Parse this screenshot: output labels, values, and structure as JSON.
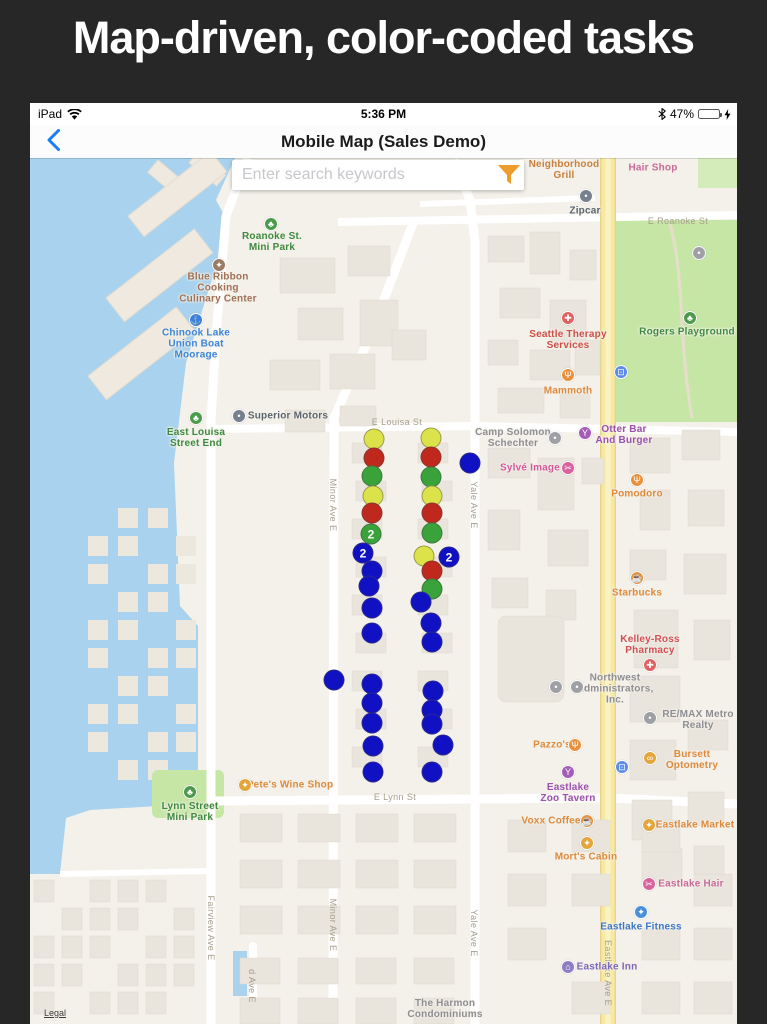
{
  "banner": {
    "title": "Map-driven, color-coded tasks"
  },
  "status_bar": {
    "carrier": "iPad",
    "time": "5:36 PM",
    "battery_percent": "47%"
  },
  "nav_bar": {
    "title": "Mobile Map (Sales Demo)"
  },
  "search": {
    "placeholder": "Enter search keywords"
  },
  "colors": {
    "accent_orange": "#EE9D2B",
    "battery_green": "#53D769",
    "nav_blue": "#157EFB",
    "marker": {
      "y": "#DCE24A",
      "r": "#BF291D",
      "g": "#3AA23A",
      "b": "#1111C4"
    }
  },
  "map": {
    "attribution": "Legal",
    "markers": [
      {
        "x": 344,
        "y": 281,
        "c": "y"
      },
      {
        "x": 344,
        "y": 300,
        "c": "r"
      },
      {
        "x": 342,
        "y": 318,
        "c": "g"
      },
      {
        "x": 343,
        "y": 338,
        "c": "y"
      },
      {
        "x": 342,
        "y": 355,
        "c": "r"
      },
      {
        "x": 341,
        "y": 376,
        "c": "g",
        "n": "2"
      },
      {
        "x": 333,
        "y": 395,
        "c": "b",
        "n": "2"
      },
      {
        "x": 342,
        "y": 413,
        "c": "b"
      },
      {
        "x": 339,
        "y": 428,
        "c": "b"
      },
      {
        "x": 342,
        "y": 450,
        "c": "b"
      },
      {
        "x": 342,
        "y": 475,
        "c": "b"
      },
      {
        "x": 342,
        "y": 526,
        "c": "b"
      },
      {
        "x": 342,
        "y": 545,
        "c": "b"
      },
      {
        "x": 342,
        "y": 565,
        "c": "b"
      },
      {
        "x": 343,
        "y": 588,
        "c": "b"
      },
      {
        "x": 343,
        "y": 614,
        "c": "b"
      },
      {
        "x": 401,
        "y": 280,
        "c": "y"
      },
      {
        "x": 401,
        "y": 299,
        "c": "r"
      },
      {
        "x": 401,
        "y": 319,
        "c": "g"
      },
      {
        "x": 402,
        "y": 338,
        "c": "y"
      },
      {
        "x": 402,
        "y": 355,
        "c": "r"
      },
      {
        "x": 402,
        "y": 375,
        "c": "g"
      },
      {
        "x": 394,
        "y": 398,
        "c": "y"
      },
      {
        "x": 419,
        "y": 399,
        "c": "b",
        "n": "2"
      },
      {
        "x": 402,
        "y": 413,
        "c": "r"
      },
      {
        "x": 402,
        "y": 431,
        "c": "g"
      },
      {
        "x": 391,
        "y": 444,
        "c": "b"
      },
      {
        "x": 401,
        "y": 465,
        "c": "b"
      },
      {
        "x": 402,
        "y": 484,
        "c": "b"
      },
      {
        "x": 403,
        "y": 533,
        "c": "b"
      },
      {
        "x": 402,
        "y": 552,
        "c": "b"
      },
      {
        "x": 402,
        "y": 566,
        "c": "b"
      },
      {
        "x": 413,
        "y": 587,
        "c": "b"
      },
      {
        "x": 402,
        "y": 614,
        "c": "b"
      },
      {
        "x": 440,
        "y": 305,
        "c": "b"
      },
      {
        "x": 304,
        "y": 522,
        "c": "b"
      }
    ],
    "pois": [
      {
        "name": "Neighborhood Grill",
        "lines": [
          "Neighborhood",
          "Grill"
        ],
        "tx": 534,
        "ty": 12,
        "color": "#C8803C"
      },
      {
        "name": "Hair Shop",
        "lines": [
          "Hair Shop"
        ],
        "tx": 623,
        "ty": 10,
        "color": "#C9699A"
      },
      {
        "name": "Zipcar",
        "lines": [
          "Zipcar"
        ],
        "tx": 555,
        "ty": 53,
        "color": "#5B6570",
        "icon": {
          "g": "•",
          "bg": "#76808E",
          "x": 556,
          "y": 38
        }
      },
      {
        "name": "Rogers Playground",
        "lines": [
          "Rogers Playground"
        ],
        "tx": 657,
        "ty": 174,
        "color": "#3E8A3E",
        "icon": {
          "g": "♣",
          "bg": "#4C9B4C",
          "x": 660,
          "y": 160
        }
      },
      {
        "name": "Seattle Therapy Services",
        "lines": [
          "Seattle Therapy",
          "Services"
        ],
        "tx": 538,
        "ty": 182,
        "color": "#CE4F46",
        "icon": {
          "g": "✚",
          "bg": "#E16060",
          "x": 538,
          "y": 160
        }
      },
      {
        "name": "Mammoth",
        "lines": [
          "Mammoth"
        ],
        "tx": 538,
        "ty": 233,
        "color": "#DD8A3C",
        "icon": {
          "g": "Ψ",
          "bg": "#E8913C",
          "x": 538,
          "y": 217
        }
      },
      {
        "name": "Camp Solomon Schechter",
        "lines": [
          "Camp Solomon",
          "Schechter"
        ],
        "tx": 483,
        "ty": 280,
        "color": "#8E8E93",
        "icon": {
          "g": "•",
          "bg": "#9FA0A5",
          "x": 525,
          "y": 280
        }
      },
      {
        "name": "Otter Bar And Burger",
        "lines": [
          "Otter Bar",
          "And Burger"
        ],
        "tx": 594,
        "ty": 277,
        "color": "#9C50B0",
        "icon": {
          "g": "Y",
          "bg": "#A55CB8",
          "x": 555,
          "y": 275
        }
      },
      {
        "name": "Sylvé Image",
        "lines": [
          "Sylvé Image"
        ],
        "tx": 500,
        "ty": 310,
        "color": "#D4579F",
        "icon": {
          "g": "✂",
          "bg": "#D8619E",
          "x": 538,
          "y": 310
        }
      },
      {
        "name": "Pomodoro",
        "lines": [
          "Pomodoro"
        ],
        "tx": 607,
        "ty": 336,
        "color": "#DD8A3C",
        "icon": {
          "g": "Ψ",
          "bg": "#E8913C",
          "x": 607,
          "y": 322
        }
      },
      {
        "name": "Starbucks",
        "lines": [
          "Starbucks"
        ],
        "tx": 607,
        "ty": 435,
        "color": "#DD8A3C",
        "icon": {
          "g": "☕",
          "bg": "#E8913C",
          "x": 607,
          "y": 420
        }
      },
      {
        "name": "Kelley-Ross Pharmacy",
        "lines": [
          "Kelley-Ross",
          "Pharmacy"
        ],
        "tx": 620,
        "ty": 487,
        "color": "#D14F55",
        "icon": {
          "g": "✚",
          "bg": "#E16060",
          "x": 620,
          "y": 507
        }
      },
      {
        "name": "Northwest Administrators, Inc.",
        "lines": [
          "Northwest",
          "Administrators,",
          "Inc."
        ],
        "tx": 585,
        "ty": 531,
        "color": "#8E8E93"
      },
      {
        "name": "office-dot-1",
        "lines": [],
        "tx": 0,
        "ty": 0,
        "color": "#8E8E93",
        "icon": {
          "g": "•",
          "bg": "#9FA0A5",
          "x": 526,
          "y": 529
        }
      },
      {
        "name": "office-dot-2",
        "lines": [],
        "tx": 0,
        "ty": 0,
        "color": "#8E8E93",
        "icon": {
          "g": "•",
          "bg": "#9FA0A5",
          "x": 547,
          "y": 529
        }
      },
      {
        "name": "RE/MAX Metro Realty",
        "lines": [
          "RE/MAX Metro",
          "Realty"
        ],
        "tx": 668,
        "ty": 562,
        "color": "#8E8E93",
        "icon": {
          "g": "•",
          "bg": "#9FA0A5",
          "x": 620,
          "y": 560
        }
      },
      {
        "name": "Pazzo's",
        "lines": [
          "Pazzo's"
        ],
        "tx": 522,
        "ty": 587,
        "color": "#DD8A3C",
        "icon": {
          "g": "Ψ",
          "bg": "#E8913C",
          "x": 545,
          "y": 587
        }
      },
      {
        "name": "Bursett Optometry",
        "lines": [
          "Bursett",
          "Optometry"
        ],
        "tx": 662,
        "ty": 602,
        "color": "#DD8A3C",
        "icon": {
          "g": "∞",
          "bg": "#E2A63D",
          "x": 620,
          "y": 600
        }
      },
      {
        "name": "Eastlake Zoo Tavern",
        "lines": [
          "Eastlake",
          "Zoo Tavern"
        ],
        "tx": 538,
        "ty": 635,
        "color": "#9C50B0",
        "icon": {
          "g": "Y",
          "bg": "#A55CB8",
          "x": 538,
          "y": 614
        }
      },
      {
        "name": "Pete's Wine Shop",
        "lines": [
          "Pete's Wine Shop"
        ],
        "tx": 260,
        "ty": 627,
        "color": "#DD8A3C",
        "icon": {
          "g": "✦",
          "bg": "#E2A63D",
          "x": 215,
          "y": 627
        }
      },
      {
        "name": "Lynn Street Mini Park",
        "lines": [
          "Lynn Street",
          "Mini Park"
        ],
        "tx": 160,
        "ty": 654,
        "color": "#3E8A3E",
        "icon": {
          "g": "♣",
          "bg": "#4C9B4C",
          "x": 160,
          "y": 634
        }
      },
      {
        "name": "Voxx Coffee",
        "lines": [
          "Voxx Coffee"
        ],
        "tx": 521,
        "ty": 663,
        "color": "#DD8A3C",
        "icon": {
          "g": "☕",
          "bg": "#E8913C",
          "x": 557,
          "y": 663
        }
      },
      {
        "name": "Eastlake Market",
        "lines": [
          "Eastlake Market"
        ],
        "tx": 665,
        "ty": 667,
        "color": "#DD8A3C",
        "icon": {
          "g": "✦",
          "bg": "#E2A63D",
          "x": 619,
          "y": 667
        }
      },
      {
        "name": "Mort's Cabin",
        "lines": [
          "Mort's Cabin"
        ],
        "tx": 556,
        "ty": 699,
        "color": "#DD8A3C",
        "icon": {
          "g": "✦",
          "bg": "#E2A63D",
          "x": 557,
          "y": 685
        }
      },
      {
        "name": "Eastlake Hair",
        "lines": [
          "Eastlake Hair"
        ],
        "tx": 661,
        "ty": 726,
        "color": "#C9699A",
        "icon": {
          "g": "✂",
          "bg": "#D8619E",
          "x": 619,
          "y": 726
        }
      },
      {
        "name": "Eastlake Fitness",
        "lines": [
          "Eastlake Fitness"
        ],
        "tx": 611,
        "ty": 769,
        "color": "#3C78C8",
        "icon": {
          "g": "✦",
          "bg": "#4A90D9",
          "x": 611,
          "y": 754
        }
      },
      {
        "name": "Eastlake Inn",
        "lines": [
          "Eastlake Inn"
        ],
        "tx": 577,
        "ty": 809,
        "color": "#7B68B8",
        "icon": {
          "g": "⌂",
          "bg": "#8E7CC3",
          "x": 538,
          "y": 809
        }
      },
      {
        "name": "The Harmon Condominiums",
        "lines": [
          "The Harmon",
          "Condominiums"
        ],
        "tx": 415,
        "ty": 851,
        "color": "#8E8E93"
      },
      {
        "name": "Blue Ribbon Cooking Culinary Center",
        "lines": [
          "Blue Ribbon",
          "Cooking",
          "Culinary Center"
        ],
        "tx": 188,
        "ty": 130,
        "color": "#9F7055",
        "icon": {
          "g": "✦",
          "bg": "#9A7B63",
          "x": 189,
          "y": 107
        }
      },
      {
        "name": "Chinook Lake Union Boat Moorage",
        "lines": [
          "Chinook Lake",
          "Union Boat",
          "Moorage"
        ],
        "tx": 166,
        "ty": 186,
        "color": "#3C86D8",
        "icon": {
          "g": "⚓",
          "bg": "#3B7EDE",
          "x": 166,
          "y": 162
        }
      },
      {
        "name": "Roanoke St. Mini Park",
        "lines": [
          "Roanoke St.",
          "Mini Park"
        ],
        "tx": 242,
        "ty": 84,
        "color": "#3E8A3E",
        "icon": {
          "g": "♣",
          "bg": "#4C9B4C",
          "x": 241,
          "y": 66
        }
      },
      {
        "name": "East Louisa Street End",
        "lines": [
          "East Louisa",
          "Street End"
        ],
        "tx": 166,
        "ty": 280,
        "color": "#3E8A3E",
        "icon": {
          "g": "♣",
          "bg": "#4C9B4C",
          "x": 166,
          "y": 260
        }
      },
      {
        "name": "Superior Motors",
        "lines": [
          "Superior Motors"
        ],
        "tx": 258,
        "ty": 258,
        "color": "#5B6570",
        "icon": {
          "g": "•",
          "bg": "#76808E",
          "x": 209,
          "y": 258
        }
      },
      {
        "name": "park-restroom",
        "lines": [],
        "tx": 0,
        "ty": 0,
        "color": "#8E8E93",
        "icon": {
          "g": "•",
          "bg": "#9FA0A5",
          "x": 669,
          "y": 95
        }
      },
      {
        "name": "transit-stop-1",
        "lines": [],
        "tx": 0,
        "ty": 0,
        "color": "#5C8BE8",
        "icon": {
          "g": "⊡",
          "bg": "#5C8BE8",
          "x": 591,
          "y": 214
        }
      },
      {
        "name": "transit-stop-2",
        "lines": [],
        "tx": 0,
        "ty": 0,
        "color": "#5C8BE8",
        "icon": {
          "g": "⊡",
          "bg": "#5C8BE8",
          "x": 592,
          "y": 609
        }
      }
    ],
    "street_labels": [
      {
        "name": "E Roanoke St",
        "x": 648,
        "y": 63,
        "vertical": false
      },
      {
        "name": "E Louisa St",
        "x": 367,
        "y": 264,
        "vertical": false
      },
      {
        "name": "E Lynn St",
        "x": 365,
        "y": 639,
        "vertical": false
      },
      {
        "name": "Fairview Ave E",
        "x": 181,
        "y": 770,
        "vertical": true
      },
      {
        "name": "Minor Ave E",
        "x": 303,
        "y": 347,
        "vertical": true
      },
      {
        "name": "Minor Ave E",
        "x": 303,
        "y": 767,
        "vertical": true
      },
      {
        "name": "Yale Ave E",
        "x": 444,
        "y": 347,
        "vertical": true
      },
      {
        "name": "Yale Ave E",
        "x": 444,
        "y": 775,
        "vertical": true
      },
      {
        "name": "d Ave E",
        "x": 222,
        "y": 828,
        "vertical": true
      },
      {
        "name": "Eastlake Ave E",
        "x": 578,
        "y": 815,
        "vertical": true
      }
    ]
  }
}
